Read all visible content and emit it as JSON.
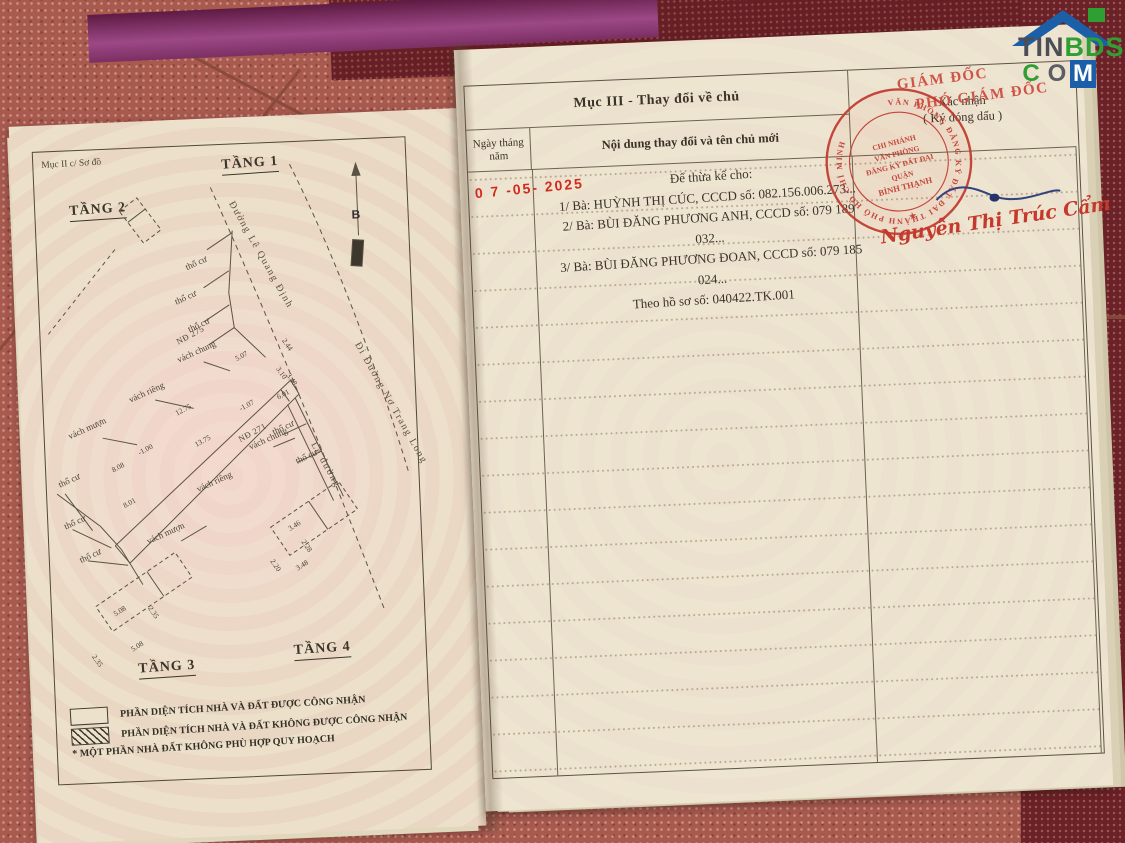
{
  "logo": {
    "tin": "TIN",
    "bds": "BDS",
    "c": "C",
    "o": "O",
    "m": "M"
  },
  "left_page": {
    "section_label": "Mục II c/ Sơ đồ",
    "floor1": "TẦNG 1",
    "floor2": "TẦNG 2",
    "floor3": "TẦNG 3",
    "floor4": "TẦNG 4",
    "plan_labels": [
      {
        "t": "Đường Lê Quang Định",
        "x": 196,
        "y": 52,
        "r": 63,
        "k": "street"
      },
      {
        "t": "Đi Đường Nơ Trang Long",
        "x": 316,
        "y": 198,
        "r": 63,
        "k": "street"
      },
      {
        "t": "Lề đường",
        "x": 268,
        "y": 296,
        "r": 63,
        "k": "street"
      },
      {
        "t": "B",
        "x": 316,
        "y": 68,
        "r": 0,
        "k": "b"
      },
      {
        "t": "NĐ 275",
        "x": 136,
        "y": 190,
        "r": -26,
        "k": "nd"
      },
      {
        "t": "NĐ 271",
        "x": 194,
        "y": 290,
        "r": -26,
        "k": "nd"
      },
      {
        "t": "thổ cư",
        "x": 148,
        "y": 116,
        "r": -22,
        "k": "lbl"
      },
      {
        "t": "thổ cư",
        "x": 136,
        "y": 150,
        "r": -22,
        "k": "lbl"
      },
      {
        "t": "thổ cư",
        "x": 148,
        "y": 178,
        "r": -22,
        "k": "lbl"
      },
      {
        "t": "thổ cư",
        "x": 228,
        "y": 284,
        "r": -22,
        "k": "lbl"
      },
      {
        "t": "thổ cư",
        "x": 250,
        "y": 314,
        "r": -22,
        "k": "lbl"
      },
      {
        "t": "thổ cư",
        "x": 12,
        "y": 328,
        "r": -22,
        "k": "lbl"
      },
      {
        "t": "thổ cư",
        "x": 16,
        "y": 370,
        "r": -22,
        "k": "lbl"
      },
      {
        "t": "thổ cư",
        "x": 30,
        "y": 404,
        "r": -22,
        "k": "lbl"
      },
      {
        "t": "vách chung",
        "x": 136,
        "y": 208,
        "r": -22,
        "k": "lbl"
      },
      {
        "t": "vách chung",
        "x": 204,
        "y": 298,
        "r": -22,
        "k": "lbl"
      },
      {
        "t": "vách riêng",
        "x": 86,
        "y": 246,
        "r": -22,
        "k": "lbl"
      },
      {
        "t": "vách riêng",
        "x": 150,
        "y": 338,
        "r": -22,
        "k": "lbl"
      },
      {
        "t": "vách mượn",
        "x": 24,
        "y": 280,
        "r": -22,
        "k": "lbl"
      },
      {
        "t": "vách mượn",
        "x": 98,
        "y": 388,
        "r": -22,
        "k": "lbl"
      },
      {
        "t": "5.07",
        "x": 194,
        "y": 210,
        "r": -26,
        "k": "dim"
      },
      {
        "t": "6.01",
        "x": 234,
        "y": 250,
        "r": -26,
        "k": "dim"
      },
      {
        "t": "2.44",
        "x": 243,
        "y": 192,
        "r": 58,
        "k": "dim"
      },
      {
        "t": "3.10",
        "x": 236,
        "y": 220,
        "r": 58,
        "k": "dim"
      },
      {
        "t": "3.48",
        "x": 246,
        "y": 227,
        "r": 58,
        "k": "dim"
      },
      {
        "t": "-1.07",
        "x": 196,
        "y": 260,
        "r": -26,
        "k": "dim"
      },
      {
        "t": "12.75",
        "x": 132,
        "y": 262,
        "r": -26,
        "k": "dim"
      },
      {
        "t": "13.75",
        "x": 150,
        "y": 294,
        "r": -26,
        "k": "dim"
      },
      {
        "t": "8.08",
        "x": 66,
        "y": 316,
        "r": -26,
        "k": "dim"
      },
      {
        "t": "8.01",
        "x": 76,
        "y": 352,
        "r": -26,
        "k": "dim"
      },
      {
        "t": "-1.00",
        "x": 93,
        "y": 300,
        "r": -26,
        "k": "dim"
      },
      {
        "t": "3.46",
        "x": 240,
        "y": 382,
        "r": -30,
        "k": "dim"
      },
      {
        "t": "3.48",
        "x": 246,
        "y": 422,
        "r": -30,
        "k": "dim"
      },
      {
        "t": "2.20",
        "x": 222,
        "y": 412,
        "r": 58,
        "k": "dim"
      },
      {
        "t": "2.28",
        "x": 254,
        "y": 394,
        "r": 58,
        "k": "dim"
      },
      {
        "t": "5.08",
        "x": 62,
        "y": 460,
        "r": -30,
        "k": "dim"
      },
      {
        "t": "5.08",
        "x": 78,
        "y": 496,
        "r": -30,
        "k": "dim"
      },
      {
        "t": "2.35",
        "x": 98,
        "y": 454,
        "r": 58,
        "k": "dim"
      },
      {
        "t": "2.35",
        "x": 40,
        "y": 500,
        "r": 58,
        "k": "dim"
      }
    ],
    "legend": {
      "item1": "PHẦN DIỆN TÍCH NHÀ VÀ ĐẤT ĐƯỢC CÔNG NHẬN",
      "item2": "PHẦN DIỆN TÍCH NHÀ VÀ ĐẤT KHÔNG ĐƯỢC CÔNG NHẬN",
      "note": "* MỘT PHẦN NHÀ ĐẤT KHÔNG PHÙ HỢP QUY HOẠCH"
    }
  },
  "right_page": {
    "section_title": "Mục III - Thay đổi về chủ",
    "confirm_1": "Xác nhận",
    "confirm_2": "( Ký đóng dấu )",
    "col_date_1": "Ngày tháng",
    "col_date_2": "năm",
    "col_content": "Nội dung thay đổi và tên chủ mới",
    "entry": {
      "date": "0 7 -05- 2025",
      "line0": "Để thừa kế cho:",
      "line1": "1/ Bà: HUỲNH THỊ CÚC, CCCD số: 082.156.006.273...",
      "line2": "2/ Bà: BÙI ĐĂNG PHƯƠNG ANH, CCCD số: 079 189 032...",
      "line3": "3/ Bà: BÙI ĐĂNG PHƯƠNG ĐOAN, CCCD số: 079 185 024...",
      "line4": "Theo hồ sơ số: 040422.TK.001"
    },
    "approval": {
      "title1": "GIÁM ĐỐC",
      "title2": "PHÓ GIÁM ĐỐC",
      "signer": "Nguyễn Thị Trúc Cẩm",
      "seal_ring": "VĂN PHÒNG ĐĂNG KÝ ĐẤT ĐAI THÀNH PHỐ HỒ CHÍ MINH",
      "seal_l1": "CHI NHÁNH",
      "seal_l2": "VĂN PHÒNG",
      "seal_l3": "ĐĂNG KÝ ĐẤT ĐAI",
      "seal_l4": "QUẬN",
      "seal_l5": "BÌNH THẠNH",
      "seal_star": "★"
    }
  }
}
